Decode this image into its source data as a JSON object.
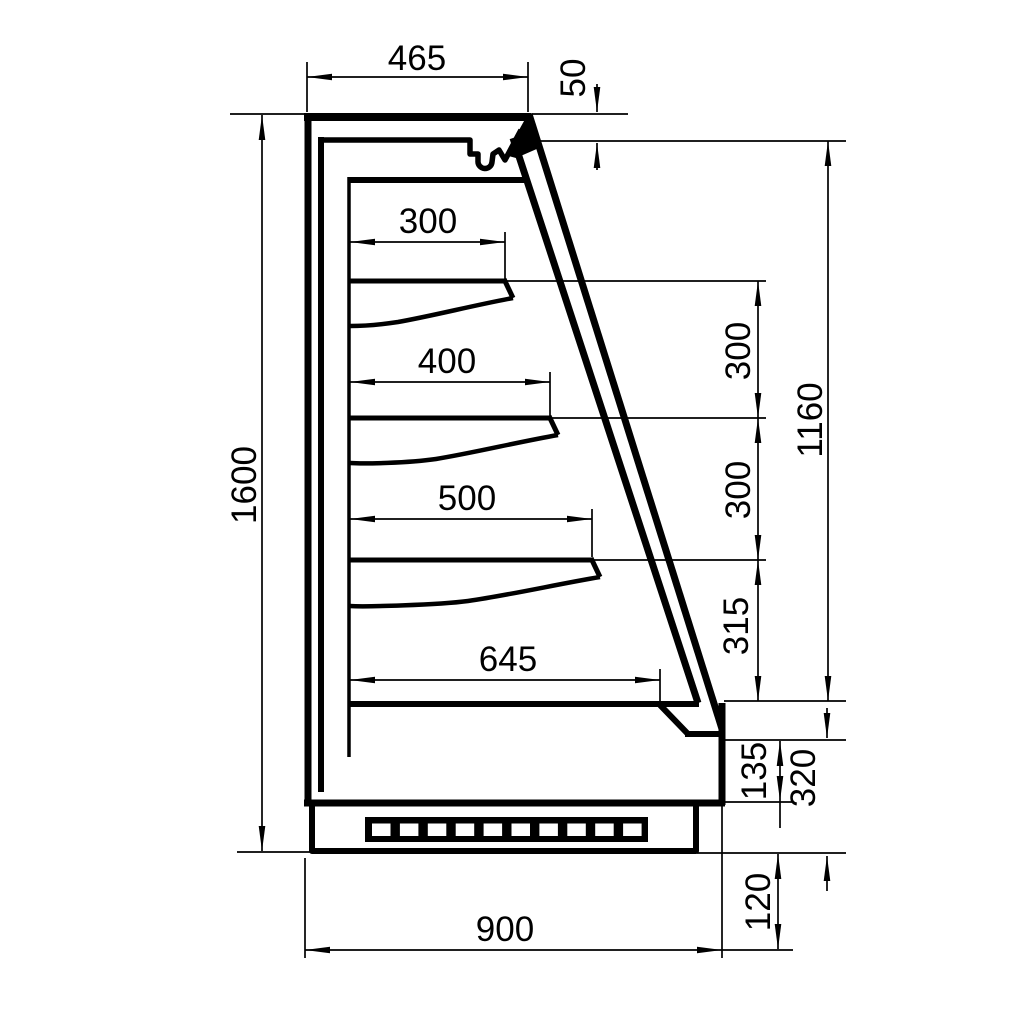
{
  "drawing": {
    "colors": {
      "line": "#000000",
      "background": "#ffffff"
    },
    "dimensions": {
      "top_depth": "465",
      "canopy_front_height": "50",
      "shelf_1_depth": "300",
      "shelf_2_depth": "400",
      "shelf_3_depth": "500",
      "base_shelf_depth": "645",
      "overall_height": "1600",
      "shelf_gap_1": "300",
      "shelf_gap_2": "300",
      "shelf_gap_3": "315",
      "front_opening_height": "1160",
      "bumper_height": "135",
      "base_section_height": "320",
      "plinth_height": "120",
      "overall_depth": "900"
    }
  }
}
